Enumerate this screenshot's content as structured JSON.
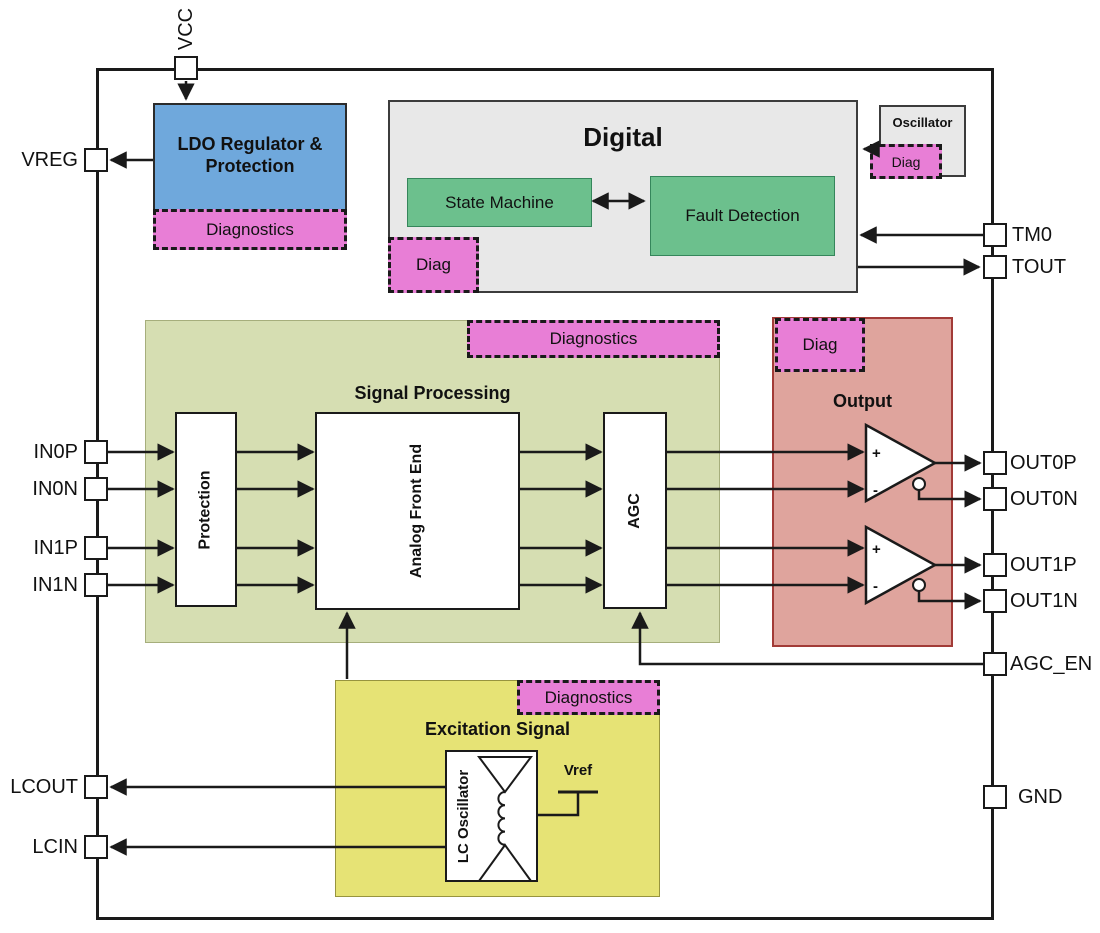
{
  "pins": {
    "vcc": "VCC",
    "vreg": "VREG",
    "in0p": "IN0P",
    "in0n": "IN0N",
    "in1p": "IN1P",
    "in1n": "IN1N",
    "lcout": "LCOUT",
    "lcin": "LCIN",
    "tm0": "TM0",
    "tout": "TOUT",
    "out0p": "OUT0P",
    "out0n": "OUT0N",
    "out1p": "OUT1P",
    "out1n": "OUT1N",
    "agc_en": "AGC_EN",
    "gnd": "GND"
  },
  "blocks": {
    "ldo": {
      "title": "LDO Regulator & Protection",
      "diagnostics_label": "Diagnostics"
    },
    "digital": {
      "title": "Digital",
      "state_machine": "State Machine",
      "fault_detection": "Fault Detection",
      "diag_label": "Diag"
    },
    "oscillator": {
      "title": "Oscillator",
      "diag_label": "Diag"
    },
    "signal_processing": {
      "title": "Signal Processing",
      "diagnostics_label": "Diagnostics",
      "protection": "Protection",
      "analog_front_end": "Analog Front End",
      "agc": "AGC"
    },
    "output": {
      "title": "Output",
      "diag_label": "Diag",
      "opamp_plus": "+",
      "opamp_minus": "-"
    },
    "excitation": {
      "title": "Excitation Signal",
      "diagnostics_label": "Diagnostics",
      "lc_oscillator": "LC Oscillator",
      "vref": "Vref"
    }
  },
  "colors": {
    "ldo_blue": "#6FA8DC",
    "diagnostics_magenta": "#E87ED6",
    "logic_green": "#6CC08D",
    "digital_gray": "#E8E8E8",
    "signal_processing_green": "#D6DEB2",
    "output_pink": "#DFA49D",
    "excitation_yellow": "#E6E375"
  }
}
